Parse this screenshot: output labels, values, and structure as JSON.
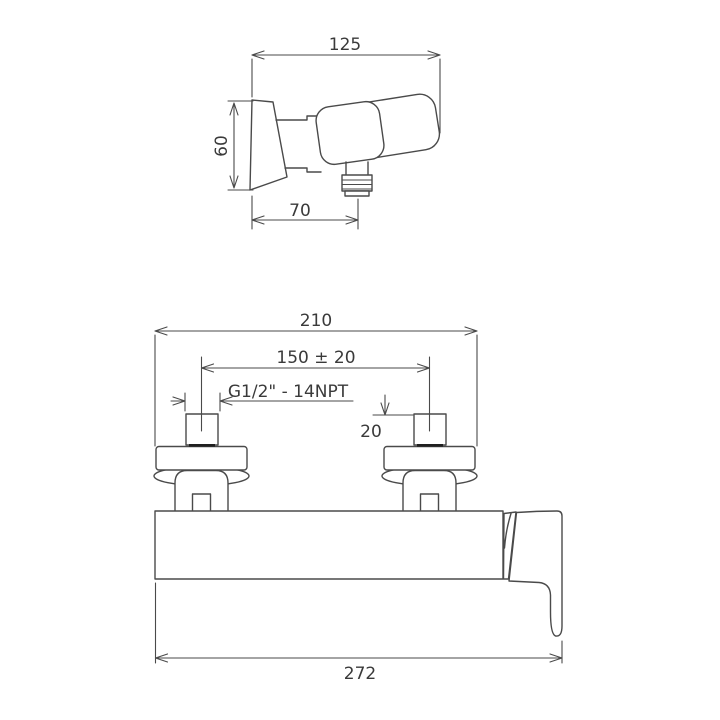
{
  "colors": {
    "line": "#4a4a4a",
    "text": "#3a3a3a",
    "thick": "#1f1f1f",
    "background": "#ffffff"
  },
  "drawing": {
    "side_view": {
      "width_mm": "125",
      "height_mm": "60",
      "outlet_offset_mm": "70"
    },
    "front_view": {
      "overall_width_mm": "210",
      "connection_centers_mm": "150 ± 20",
      "thread_spec": "G1/2\" - 14NPT",
      "nut_depth_mm": "20",
      "total_width_mm": "272"
    }
  }
}
